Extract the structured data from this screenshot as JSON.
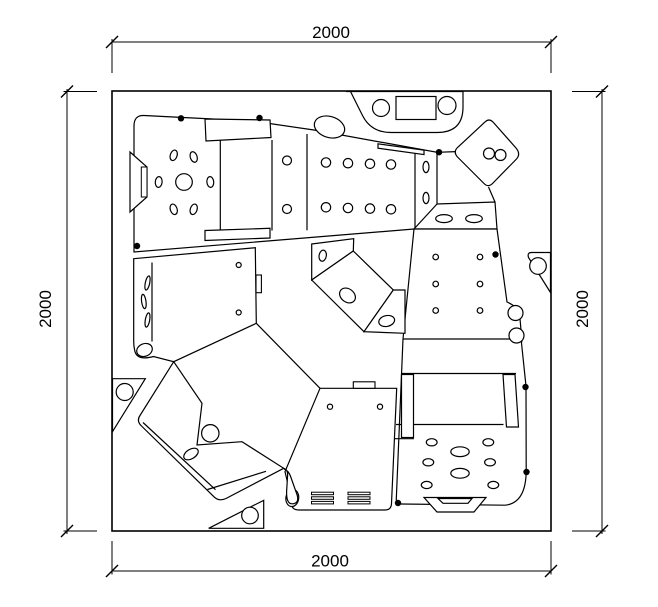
{
  "page": {
    "background": "#ffffff",
    "line_color": "#000000"
  },
  "dimensions": {
    "top_label": "2000",
    "bottom_label": "2000",
    "left_label": "2000",
    "right_label": "2000"
  },
  "drawing": {
    "width": 658,
    "height": 607,
    "elements": [
      {
        "t": "rect",
        "x": 112,
        "y": 91,
        "w": 439,
        "h": 440,
        "f": "#fff",
        "sw": 1.6
      },
      {
        "t": "path",
        "d": "M134,252 L134,126 Q134,115 144,115.5 L252,121 L314,130 L437,152.3 L437,204 L495,202 L497,229 L414,229 Z",
        "f": "#fff"
      },
      {
        "t": "path",
        "d": "M147,167 L147,197 L130,212 L130,152 Z",
        "f": "#fff"
      },
      {
        "t": "rect",
        "x": 141.3,
        "y": 167,
        "w": 5.7,
        "h": 30,
        "f": "#fff",
        "sw": 1
      },
      {
        "t": "line",
        "x1": 220.3,
        "y1": 139,
        "x2": 220.3,
        "y2": 230
      },
      {
        "t": "line",
        "x1": 272,
        "y1": 140,
        "x2": 272,
        "y2": 230.5
      },
      {
        "t": "line",
        "x1": 307,
        "y1": 134,
        "x2": 307,
        "y2": 230.3
      },
      {
        "t": "line",
        "x1": 415,
        "y1": 150,
        "x2": 415,
        "y2": 228
      },
      {
        "t": "line",
        "x1": 414,
        "y1": 229,
        "x2": 437,
        "y2": 204
      },
      {
        "t": "path",
        "d": "M205,119 L270,120 L271,137.5 L206,141 Z",
        "f": "#fff"
      },
      {
        "t": "path",
        "d": "M205,230.5 L270,228.3 L270,238 L205,240.5 Z",
        "f": "#fff"
      },
      {
        "t": "ellipse",
        "cx": 329.5,
        "cy": 127,
        "rx": 15.5,
        "ry": 10.5,
        "rot": 17,
        "f": "#fff"
      },
      {
        "t": "path",
        "d": "M378,143.8 L424,150.2 L424,154.6 L378,148.2 Z",
        "f": "#fff"
      },
      {
        "t": "circle",
        "cx": 184,
        "cy": 182,
        "r": 8.3
      },
      {
        "t": "ellipse",
        "cx": 173.7,
        "cy": 155.3,
        "rx": 3.4,
        "ry": 5.4,
        "rot": 18
      },
      {
        "t": "ellipse",
        "cx": 193.7,
        "cy": 157,
        "rx": 3.4,
        "ry": 5.4,
        "rot": -18
      },
      {
        "t": "ellipse",
        "cx": 158.7,
        "cy": 182,
        "rx": 3.4,
        "ry": 5.4,
        "rot": 5
      },
      {
        "t": "ellipse",
        "cx": 210.3,
        "cy": 182,
        "rx": 3.4,
        "ry": 5.4,
        "rot": -5
      },
      {
        "t": "ellipse",
        "cx": 173.7,
        "cy": 209.3,
        "rx": 3.4,
        "ry": 5.4,
        "rot": -18
      },
      {
        "t": "ellipse",
        "cx": 193.7,
        "cy": 209.3,
        "rx": 3.4,
        "ry": 5.4,
        "rot": 18
      },
      {
        "t": "circle",
        "cx": 287,
        "cy": 160.5,
        "r": 4.5
      },
      {
        "t": "circle",
        "cx": 287,
        "cy": 209,
        "r": 4.5
      },
      {
        "t": "circle",
        "cx": 326,
        "cy": 162.5,
        "r": 4.7
      },
      {
        "t": "circle",
        "cx": 348,
        "cy": 163.2,
        "r": 4.7
      },
      {
        "t": "circle",
        "cx": 370,
        "cy": 163.8,
        "r": 4.7
      },
      {
        "t": "circle",
        "cx": 391,
        "cy": 164.5,
        "r": 4.7
      },
      {
        "t": "circle",
        "cx": 326,
        "cy": 207.3,
        "r": 4.7
      },
      {
        "t": "circle",
        "cx": 348,
        "cy": 208,
        "r": 4.7
      },
      {
        "t": "circle",
        "cx": 370,
        "cy": 208.6,
        "r": 4.7
      },
      {
        "t": "circle",
        "cx": 391,
        "cy": 209.3,
        "r": 4.7
      },
      {
        "t": "ellipse",
        "cx": 426,
        "cy": 167,
        "rx": 3,
        "ry": 5.6,
        "rot": 0
      },
      {
        "t": "ellipse",
        "cx": 426,
        "cy": 198,
        "rx": 3,
        "ry": 5.6,
        "rot": 0
      },
      {
        "t": "ellipse",
        "cx": 444,
        "cy": 218.6,
        "rx": 8.3,
        "ry": 4,
        "rot": 0
      },
      {
        "t": "ellipse",
        "cx": 474,
        "cy": 218.6,
        "rx": 8.3,
        "ry": 4,
        "rot": 0
      },
      {
        "t": "path",
        "d": "M346,91.5 L463,91.5 L463,107 Q463,132.5 437,132.5 L391,132.5 Q371,132.5 362.5,115.5 L350.5,91.5 Z",
        "f": "#fff"
      },
      {
        "t": "circle",
        "cx": 381,
        "cy": 108,
        "r": 8.5
      },
      {
        "t": "circle",
        "cx": 447,
        "cy": 105.5,
        "r": 9
      },
      {
        "t": "rect",
        "x": 396,
        "y": 96.5,
        "w": 40,
        "h": 23,
        "f": "#fff",
        "sw": 1.2
      },
      {
        "t": "path",
        "d": "M485,122 Q489,118 493,122 L516,148 Q521,154 516.5,159 L493,183 Q488.5,188 484,183.5 L457.5,157 Q453,152 457.5,147.5 Z",
        "f": "#fff"
      },
      {
        "t": "circle",
        "cx": 489,
        "cy": 153.5,
        "r": 5.5
      },
      {
        "t": "circle",
        "cx": 500.5,
        "cy": 155,
        "r": 5.5
      },
      {
        "t": "line",
        "x1": 437,
        "y1": 152.3,
        "x2": 456,
        "y2": 151.6
      },
      {
        "t": "line",
        "x1": 488.5,
        "y1": 187,
        "x2": 495,
        "y2": 202
      },
      {
        "t": "path",
        "d": "M414,229 L497,229 L507,302 Q517,306.5 519.5,313 L521,330 Q523,336.5 521.5,343 L526,386 L526.2,468 Q526.8,503 505,505.2 L401,504 Q396,504 396.3,499 L403,339 Z",
        "f": "#fff"
      },
      {
        "t": "circle",
        "cx": 515.5,
        "cy": 313,
        "r": 7.5,
        "f": "#fff"
      },
      {
        "t": "circle",
        "cx": 516.5,
        "cy": 335.5,
        "r": 7.5,
        "f": "#fff"
      },
      {
        "t": "line",
        "x1": 403,
        "y1": 339,
        "x2": 510,
        "y2": 339
      },
      {
        "t": "line",
        "x1": 402,
        "y1": 373.5,
        "x2": 516,
        "y2": 373.5
      },
      {
        "t": "line",
        "x1": 396,
        "y1": 424.5,
        "x2": 503.5,
        "y2": 424.5
      },
      {
        "t": "line",
        "x1": 394,
        "y1": 438.7,
        "x2": 414,
        "y2": 438.7
      },
      {
        "t": "rect",
        "x": 401.5,
        "y": 374.5,
        "w": 12,
        "h": 63,
        "f": "#fff",
        "sw": 1.2
      },
      {
        "t": "path",
        "d": "M503,374.5 L515,374.5 L518.5,427 L506.5,427 Z",
        "f": "#fff"
      },
      {
        "t": "circle",
        "cx": 435.7,
        "cy": 257,
        "r": 2.8
      },
      {
        "t": "circle",
        "cx": 480,
        "cy": 257,
        "r": 2.8
      },
      {
        "t": "circle",
        "cx": 435.7,
        "cy": 284,
        "r": 2.8
      },
      {
        "t": "circle",
        "cx": 480,
        "cy": 284,
        "r": 2.8
      },
      {
        "t": "circle",
        "cx": 435.7,
        "cy": 310.5,
        "r": 2.8
      },
      {
        "t": "circle",
        "cx": 480,
        "cy": 310.5,
        "r": 2.8
      },
      {
        "t": "ellipse",
        "cx": 431.7,
        "cy": 442.3,
        "rx": 5.4,
        "ry": 3.6,
        "rot": 0
      },
      {
        "t": "ellipse",
        "cx": 488.3,
        "cy": 442.3,
        "rx": 5.4,
        "ry": 3.6,
        "rot": 0
      },
      {
        "t": "ellipse",
        "cx": 428.3,
        "cy": 462.3,
        "rx": 5.4,
        "ry": 3.6,
        "rot": 0
      },
      {
        "t": "ellipse",
        "cx": 490,
        "cy": 462.3,
        "rx": 5.4,
        "ry": 3.6,
        "rot": 0
      },
      {
        "t": "ellipse",
        "cx": 426.7,
        "cy": 485,
        "rx": 5.4,
        "ry": 3.6,
        "rot": 0
      },
      {
        "t": "ellipse",
        "cx": 493.3,
        "cy": 485,
        "rx": 5.4,
        "ry": 3.6,
        "rot": 0
      },
      {
        "t": "ellipse",
        "cx": 460,
        "cy": 451.7,
        "rx": 9.2,
        "ry": 4.9,
        "rot": 0
      },
      {
        "t": "ellipse",
        "cx": 460,
        "cy": 473.3,
        "rx": 9.2,
        "ry": 4.9,
        "rot": 0
      },
      {
        "t": "path",
        "d": "M424,497.5 L486,497.5 L474,512 L437,512 Z",
        "f": "#fff"
      },
      {
        "t": "path",
        "d": "M438,498.5 L472,498.5 L468,503.3 L443,503.3 Z",
        "f": "#fff"
      },
      {
        "t": "path",
        "d": "M531.5,252.5 Q527,252.5 528.5,257.5 L550.5,292.5 L550.5,252.5 Z",
        "f": "#fff"
      },
      {
        "t": "circle",
        "cx": 538,
        "cy": 266,
        "r": 8.3
      },
      {
        "t": "path",
        "d": "M112.5,378.7 L145.3,378.7 L112.5,431.7 Z",
        "f": "#fff"
      },
      {
        "t": "circle",
        "cx": 124.7,
        "cy": 392,
        "r": 8.5
      },
      {
        "t": "path",
        "d": "M208.7,528.3 L263.7,500.3 L263.7,528.3 Z",
        "f": "#fff"
      },
      {
        "t": "circle",
        "cx": 250,
        "cy": 515.5,
        "r": 8.3
      },
      {
        "t": "path",
        "d": "M133.7,258.7 L255.3,247.7 L256.3,323.3 L173.7,361.7 L153.5,356.5 Q137,361 134.8,351 Q133.6,345.5 133.7,341 Z",
        "f": "#fff"
      },
      {
        "t": "ellipse",
        "cx": 144.5,
        "cy": 350,
        "rx": 8,
        "ry": 6.3,
        "rot": -22,
        "f": "#fff"
      },
      {
        "t": "line",
        "x1": 152,
        "y1": 262.5,
        "x2": 152,
        "y2": 341.5
      },
      {
        "t": "ellipse",
        "cx": 147.5,
        "cy": 283,
        "rx": 2.2,
        "ry": 7.2,
        "rot": 12
      },
      {
        "t": "ellipse",
        "cx": 143.8,
        "cy": 301.5,
        "rx": 2.2,
        "ry": 7.2,
        "rot": -8
      },
      {
        "t": "ellipse",
        "cx": 147.5,
        "cy": 320,
        "rx": 2.2,
        "ry": 7.2,
        "rot": 10
      },
      {
        "t": "circle",
        "cx": 238.7,
        "cy": 265,
        "r": 2.5
      },
      {
        "t": "circle",
        "cx": 238.7,
        "cy": 312.5,
        "r": 2.5
      },
      {
        "t": "rect",
        "x": 256,
        "y": 275,
        "w": 5.4,
        "h": 17.7,
        "f": "#fff",
        "sw": 1.1
      },
      {
        "t": "line",
        "x1": 256.3,
        "y1": 323.3,
        "x2": 320,
        "y2": 388.3
      },
      {
        "t": "path",
        "d": "M320,388.3 L396.7,388.3 L391.5,503.5 Q391.3,510 385,510 L299,510 Q290,510 291.8,500.5 L285,471.7 Z",
        "f": "#fff"
      },
      {
        "t": "ellipse",
        "cx": 292.3,
        "cy": 498,
        "rx": 6.4,
        "ry": 8.6,
        "rot": 8,
        "f": "#fff"
      },
      {
        "t": "rect",
        "x": 353.3,
        "y": 381.8,
        "w": 21.7,
        "h": 6.5,
        "f": "#fff",
        "sw": 1.1
      },
      {
        "t": "circle",
        "cx": 330,
        "cy": 406.7,
        "r": 2.6
      },
      {
        "t": "circle",
        "cx": 380,
        "cy": 406.7,
        "r": 2.6
      },
      {
        "t": "rect",
        "x": 311.5,
        "y": 492.2,
        "w": 22,
        "h": 2.5,
        "f": "#fff",
        "sw": 1
      },
      {
        "t": "rect",
        "x": 311.5,
        "y": 496.8,
        "w": 22,
        "h": 2.5,
        "f": "#fff",
        "sw": 1
      },
      {
        "t": "rect",
        "x": 311.5,
        "y": 501.4,
        "w": 22,
        "h": 2.5,
        "f": "#fff",
        "sw": 1
      },
      {
        "t": "rect",
        "x": 348,
        "y": 492.2,
        "w": 22,
        "h": 2.5,
        "f": "#fff",
        "sw": 1
      },
      {
        "t": "rect",
        "x": 348,
        "y": 496.8,
        "w": 22,
        "h": 2.5,
        "f": "#fff",
        "sw": 1
      },
      {
        "t": "rect",
        "x": 348,
        "y": 501.4,
        "w": 22,
        "h": 2.5,
        "f": "#fff",
        "sw": 1
      },
      {
        "t": "path",
        "d": "M173.7,361.7 L202,403.3 L197,445 L242,441.7 L283.7,468.3 L226,498.5 Q219,501.8 214,496.8 L141.5,426 Q136,420.8 140.3,415 Z",
        "f": "#fff"
      },
      {
        "t": "path",
        "d": "M283.7,468.3 Q288.2,469.8 287.6,475.5 L286.6,491.5 Q286.2,505.5 294,503.6 Q299.6,502 296.8,494 L290.6,476.5 Q288.6,470.8 284.6,469.2 Z",
        "f": "#fff"
      },
      {
        "t": "line",
        "x1": 143,
        "y1": 422.5,
        "x2": 215.5,
        "y2": 489.7
      },
      {
        "t": "line",
        "x1": 207.5,
        "y1": 489.5,
        "x2": 266,
        "y2": 471.3
      },
      {
        "t": "circle",
        "cx": 210.3,
        "cy": 433.3,
        "r": 8.7
      },
      {
        "t": "ellipse",
        "cx": 191,
        "cy": 454,
        "rx": 8,
        "ry": 4.7,
        "rot": -32
      },
      {
        "t": "path",
        "d": "M311.7,244 L353.7,238.7 L353.3,251 L311.7,280 Z",
        "f": "#fff"
      },
      {
        "t": "ellipse",
        "cx": 322.7,
        "cy": 255.7,
        "rx": 3.6,
        "ry": 5.6,
        "rot": 10
      },
      {
        "t": "path",
        "d": "M353.3,251 L393.3,290 L364,331.7 L311.7,280 Z",
        "f": "#fff"
      },
      {
        "t": "ellipse",
        "cx": 347.5,
        "cy": 295.5,
        "rx": 8.6,
        "ry": 6.6,
        "rot": 38
      },
      {
        "t": "path",
        "d": "M393.3,290 L405,290 L405,333.3 L364,331.7 Z",
        "f": "#fff"
      },
      {
        "t": "ellipse",
        "cx": 386.7,
        "cy": 321,
        "rx": 8,
        "ry": 5.4,
        "rot": -12
      },
      {
        "t": "dot",
        "cx": 181,
        "cy": 118.3,
        "r": 3.2
      },
      {
        "t": "dot",
        "cx": 259.5,
        "cy": 118,
        "r": 3.2
      },
      {
        "t": "dot",
        "cx": 439,
        "cy": 152.2,
        "r": 3.2
      },
      {
        "t": "dot",
        "cx": 137,
        "cy": 246,
        "r": 3.2
      },
      {
        "t": "dot",
        "cx": 495.5,
        "cy": 254.5,
        "r": 3.2
      },
      {
        "t": "dot",
        "cx": 525.5,
        "cy": 387,
        "r": 3.2
      },
      {
        "t": "dot",
        "cx": 526.5,
        "cy": 472,
        "r": 3.2
      },
      {
        "t": "dot",
        "cx": 398,
        "cy": 503,
        "r": 3.2
      },
      {
        "t": "line",
        "x1": 112,
        "y1": 39,
        "x2": 112,
        "y2": 73,
        "sw": 1
      },
      {
        "t": "line",
        "x1": 551,
        "y1": 39,
        "x2": 551,
        "y2": 73,
        "sw": 1
      },
      {
        "t": "line",
        "x1": 112,
        "y1": 42,
        "x2": 551,
        "y2": 42,
        "sw": 1
      },
      {
        "t": "line",
        "x1": 106,
        "y1": 48,
        "x2": 118,
        "y2": 36,
        "sw": 1.4
      },
      {
        "t": "line",
        "x1": 545,
        "y1": 48,
        "x2": 557,
        "y2": 36,
        "sw": 1.4
      },
      {
        "t": "line",
        "x1": 112,
        "y1": 541,
        "x2": 112,
        "y2": 574.5,
        "sw": 1
      },
      {
        "t": "line",
        "x1": 551,
        "y1": 541,
        "x2": 551,
        "y2": 574.5,
        "sw": 1
      },
      {
        "t": "line",
        "x1": 112,
        "y1": 571,
        "x2": 551,
        "y2": 571,
        "sw": 1
      },
      {
        "t": "line",
        "x1": 106,
        "y1": 577,
        "x2": 118,
        "y2": 565,
        "sw": 1.4
      },
      {
        "t": "line",
        "x1": 545,
        "y1": 577,
        "x2": 557,
        "y2": 565,
        "sw": 1.4
      },
      {
        "t": "line",
        "x1": 63.5,
        "y1": 91.5,
        "x2": 97,
        "y2": 91.5,
        "sw": 1
      },
      {
        "t": "line",
        "x1": 63.5,
        "y1": 531,
        "x2": 97,
        "y2": 531,
        "sw": 1
      },
      {
        "t": "line",
        "x1": 67,
        "y1": 89,
        "x2": 67,
        "y2": 534,
        "sw": 1
      },
      {
        "t": "line",
        "x1": 61,
        "y1": 97.5,
        "x2": 73,
        "y2": 85.5,
        "sw": 1.4
      },
      {
        "t": "line",
        "x1": 61,
        "y1": 537,
        "x2": 73,
        "y2": 525,
        "sw": 1.4
      },
      {
        "t": "line",
        "x1": 572,
        "y1": 91.5,
        "x2": 605.5,
        "y2": 91.5,
        "sw": 1
      },
      {
        "t": "line",
        "x1": 572,
        "y1": 531,
        "x2": 605.5,
        "y2": 531,
        "sw": 1
      },
      {
        "t": "line",
        "x1": 602,
        "y1": 89,
        "x2": 602,
        "y2": 534,
        "sw": 1
      },
      {
        "t": "line",
        "x1": 596,
        "y1": 97.5,
        "x2": 608,
        "y2": 85.5,
        "sw": 1.4
      },
      {
        "t": "line",
        "x1": 596,
        "y1": 537,
        "x2": 608,
        "y2": 525,
        "sw": 1.4
      }
    ]
  }
}
